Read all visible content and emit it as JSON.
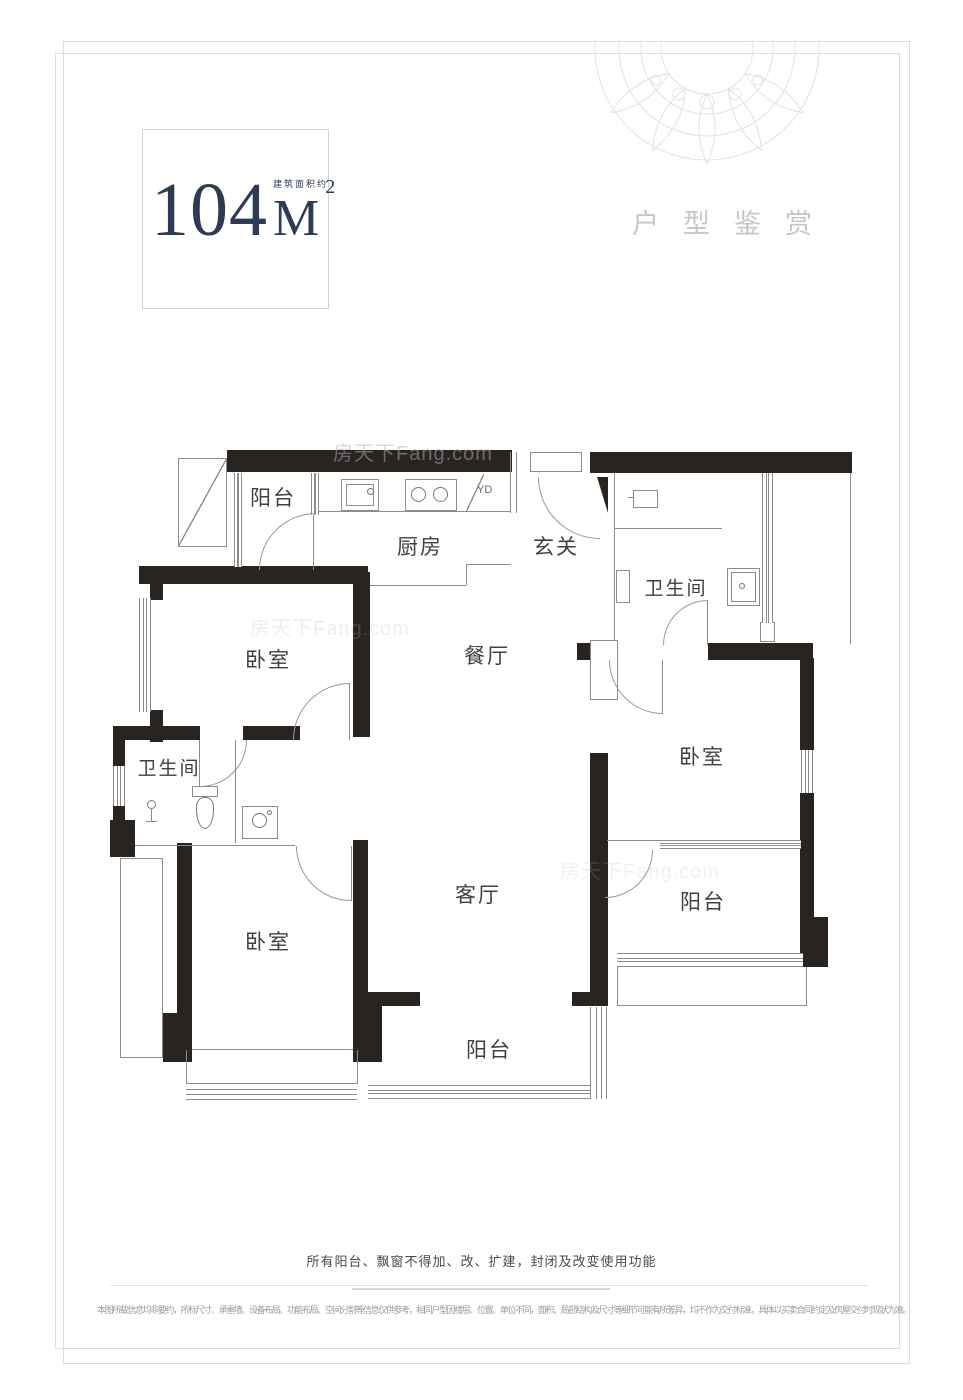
{
  "header": {
    "area_value": "104",
    "area_unit": "M",
    "area_superscript": "2",
    "area_caption": "建筑面积约",
    "section_title": "户型鉴赏"
  },
  "floorplan": {
    "rooms": [
      {
        "id": "balcony-top-left",
        "label": "阳台"
      },
      {
        "id": "kitchen",
        "label": "厨房"
      },
      {
        "id": "entry",
        "label": "玄关"
      },
      {
        "id": "bathroom-right",
        "label": "卫生间"
      },
      {
        "id": "bedroom-top-left",
        "label": "卧室"
      },
      {
        "id": "dining-room",
        "label": "餐厅"
      },
      {
        "id": "bedroom-right",
        "label": "卧室"
      },
      {
        "id": "bathroom-left",
        "label": "卫生间"
      },
      {
        "id": "living-room",
        "label": "客厅"
      },
      {
        "id": "balcony-right",
        "label": "阳台"
      },
      {
        "id": "bedroom-bottom-left",
        "label": "卧室"
      },
      {
        "id": "balcony-bottom",
        "label": "阳台"
      }
    ],
    "flue_label": "YD",
    "watermark": "房天下Fang.com"
  },
  "footer": {
    "notice": "所有阳台、飘窗不得加、改、扩建，封闭及改变使用功能",
    "disclaimer": "本图所载信息均非要约，所标尺寸、承重墙、设备布局、功能布局、空间分割等信息仅供参考，相同户型因楼层、位置、单位不同，面积、局部结构及尺寸等细节可能有所差异，均不作为交付标准，具体以买卖合同约定及房屋交付时现状为准。"
  },
  "colors": {
    "wall": "#2a2421",
    "accent_navy": "#2e3b55",
    "light_title": "#c6c6c6"
  }
}
